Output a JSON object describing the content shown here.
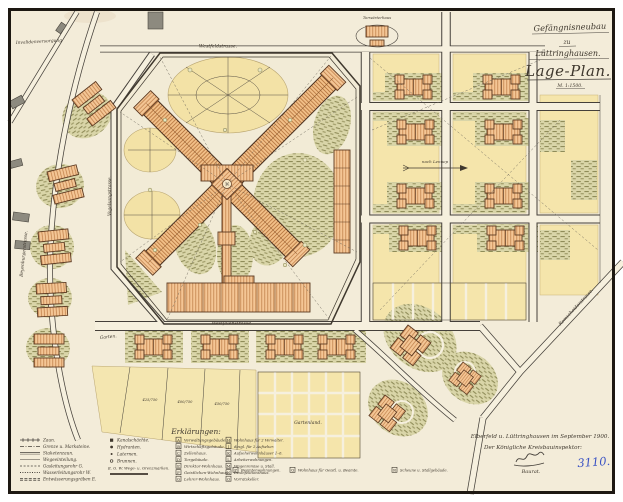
{
  "document": {
    "kind": "historical site plan (scanned hand drawing)",
    "titles": {
      "line1": "Gefängnisneubau",
      "line2": "zu",
      "line3": "Lüttringhausen.",
      "main": "Lage-Plan.",
      "scale": "M. 1:1500."
    },
    "signature": {
      "place_date": "Elberfeld u. Lüttringhausen im September 1900.",
      "office": "Der Königliche Kreisbauinspektor:",
      "name": "Müller",
      "rank": "Baurat.",
      "stamp_number": "3110."
    }
  },
  "street_labels": {
    "top_street": "Westfeldstrasse.",
    "bottom_street": "Westfalenstrasse.",
    "west_wall_street": "Vogelsangstrasse.",
    "left_road": "Beyenburgerstrasse.",
    "right_road": "Remscheiderstrasse.",
    "top_left_note": "Invalidenversorgung",
    "gatehouse_note": "Torwärterhaus",
    "garden_note": "Garten.",
    "field_note": "Gartenland.",
    "arrow_note": "nach Lennep"
  },
  "plot_numbers": {
    "p1": "425/750",
    "p2": "400/750",
    "p3": "450/750"
  },
  "legend": {
    "heading": "Erklärungen:",
    "col1": [
      {
        "label": "Zaun."
      },
      {
        "label": "Grenze u. Marksteine."
      },
      {
        "label": "Staketenzaun."
      },
      {
        "label": "Wegeeinteilung."
      },
      {
        "label": "Gasleitungsrohr G."
      },
      {
        "label": "Wasserleitungsrohr W."
      },
      {
        "label": "Entwässerungsgräben E."
      }
    ],
    "col2": [
      {
        "label": "Kanalschächte."
      },
      {
        "label": "Hydranten."
      },
      {
        "label": "Laternen."
      },
      {
        "label": "Brunnen."
      },
      {
        "label": "E. G. W. Wege- u. Grenzmarken."
      }
    ],
    "col3": [
      {
        "key": "A",
        "label": "Verwaltungsgebäude."
      },
      {
        "key": "B",
        "label": "Wirtschaftsgebäude."
      },
      {
        "key": "C",
        "label": "Zellenhaus."
      },
      {
        "key": "D",
        "label": "Torgebäude."
      },
      {
        "key": "E",
        "label": "Direktor-Wohnhaus."
      },
      {
        "key": "F",
        "label": "Geistlichen-Wohnhaus."
      },
      {
        "key": "G",
        "label": "Lehrer-Wohnhaus."
      }
    ],
    "col4": [
      {
        "key": "H",
        "label": "Wohnhaus für 2 Verwalter."
      },
      {
        "key": "J",
        "label": "desgl. für 2 Aufseher."
      },
      {
        "key": "K",
        "label": "Aufseherwohnhäuser 1–6."
      },
      {
        "key": "L",
        "label": "Arbeiterwohnungen."
      },
      {
        "key": "M",
        "label": "Wagenremise u. Stall."
      },
      {
        "key": "N",
        "label": "Desinfektionshaus."
      },
      {
        "key": "O",
        "label": "Vorratskeller."
      }
    ],
    "row_bottom": [
      {
        "key": "P",
        "label": "Beamtenwohnungen."
      },
      {
        "key": "Q",
        "label": "Wohnhaus für Geistl. u. Beamte."
      },
      {
        "key": "R",
        "label": "Scheune u. Stallgebäude."
      }
    ]
  },
  "colors": {
    "paper": "#f3ecd9",
    "ink": "#3f382e",
    "building_fill": "#f2c28e",
    "garden_yellow": "#f5e5ab",
    "vegetation_green": "#8f8c59",
    "stamp_blue": "#3b53c4"
  }
}
